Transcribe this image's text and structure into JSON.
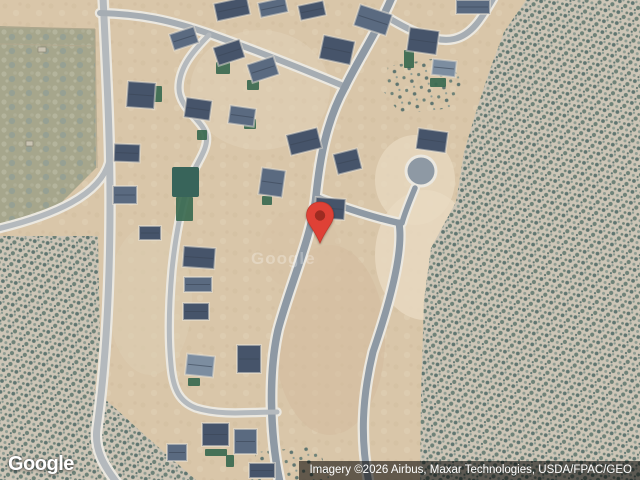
{
  "map": {
    "watermark_center": "Google",
    "logo_text": "Google",
    "attribution_text": "Imagery ©2026 Airbus, Maxar Technologies, USDA/FPAC/GEO",
    "colors": {
      "dirt": "#d9c6a9",
      "field": "#a6a68c",
      "scrub_base": "#cdc5b6",
      "scrub_dot1": "#5f7570",
      "scrub_dot2": "#6e8278",
      "scrub_dot3": "#8d9c92",
      "road_light": "#b4b9bd",
      "road_mid": "#a6adb3",
      "road_dark": "#8e99a4",
      "road_curb": "#ebe8e0",
      "house_dark": "#46546a",
      "house_mid": "#5a6a80",
      "house_light": "#7c8da0",
      "lawn": "#3a6950",
      "pond": "#38645a",
      "fence": "#b1a88e",
      "pin_red": "#df4136",
      "pin_dot": "#9e2b21"
    },
    "pin": {
      "tip_x": 320,
      "tip_y": 243
    },
    "field_polygon": "0,26 95,29 96,168 58,206 0,233",
    "field_marks": [
      [
        38,
        47,
        8,
        5
      ],
      [
        26,
        141,
        7,
        5
      ]
    ],
    "fences": [
      [
        0,
        44,
        94,
        46
      ],
      [
        95,
        29,
        97,
        168
      ],
      [
        0,
        27,
        95,
        29
      ]
    ],
    "dirt_shades": [
      [
        330,
        340,
        55,
        95,
        "#d3bc9e",
        0.55
      ],
      [
        425,
        255,
        50,
        65,
        "#e8dac2",
        0.8
      ],
      [
        415,
        180,
        40,
        45,
        "#e8dac2",
        0.7
      ],
      [
        150,
        300,
        42,
        75,
        "#dccdb2",
        0.6
      ],
      [
        260,
        90,
        70,
        60,
        "#e2d2ba",
        0.45
      ],
      [
        300,
        250,
        40,
        40,
        "#d8c2a6",
        0.5
      ]
    ],
    "scrub_areas": [
      {
        "pts": "0,236 98,236 100,340 95,390 148,438 196,480 0,480",
        "pat": "dense"
      },
      {
        "pts": "526,0 640,0 640,480 420,480 421,396 424,300 431,248 456,202 464,152 476,112 489,72 504,32",
        "pat": "dense"
      },
      {
        "pts": "388,66 438,58 463,78 452,108 400,114 384,92",
        "pat": "sparse"
      },
      {
        "pts": "256,452 318,446 330,480 250,480",
        "pat": "sparse"
      }
    ],
    "roads": [
      {
        "d": "M 109,162 C 100,195 55,215 -3,229",
        "w": 5.5,
        "c": "road_light"
      },
      {
        "d": "M 103,-3 C 106,60 110,130 110,200 C 110,300 105,370 97,428 C 94,450 104,466 117,483",
        "w": 7,
        "c": "road_light"
      },
      {
        "d": "M 100,13 C 140,14 170,20 210,34 C 260,52 310,72 346,87",
        "w": 6,
        "c": "road_mid"
      },
      {
        "d": "M 387,17 C 412,32 436,43 454,39 C 472,35 482,18 494,-3",
        "w": 6,
        "c": "road_mid"
      },
      {
        "d": "M 392,-3 C 378,30 358,60 345,87 C 326,122 320,158 316,196 C 312,236 290,285 278,330 C 269,370 269,430 280,483",
        "w": 7.5,
        "c": "road_dark"
      },
      {
        "d": "M 316,197 C 342,207 372,217 399,223",
        "w": 6.5,
        "c": "road_dark"
      },
      {
        "d": "M 399,223 C 404,252 388,308 373,352 C 362,398 360,440 369,483",
        "w": 7,
        "c": "road_dark"
      },
      {
        "d": "M 415,188 C 410,200 405,212 402,223",
        "w": 5.5,
        "c": "road_dark"
      },
      {
        "d": "M 209,35 C 192,52 179,68 179,88 C 179,108 202,120 206,134 C 210,150 193,166 188,185 C 180,212 175,240 172,270 C 169,305 168,335 171,365 C 173,390 180,402 196,408 C 222,416 250,412 277,412",
        "w": 5,
        "c": "road_light"
      }
    ],
    "culdesac": {
      "cx": 421,
      "cy": 171,
      "r": 13.5
    },
    "pond": [
      172,
      167,
      27,
      30
    ],
    "lawns": [
      [
        216,
        62,
        14,
        12
      ],
      [
        247,
        80,
        12,
        10
      ],
      [
        404,
        50,
        10,
        18
      ],
      [
        430,
        78,
        16,
        9
      ],
      [
        176,
        197,
        17,
        24
      ],
      [
        244,
        119,
        12,
        10
      ],
      [
        262,
        196,
        10,
        9
      ],
      [
        205,
        449,
        22,
        7
      ],
      [
        226,
        455,
        8,
        12
      ],
      [
        188,
        378,
        12,
        8
      ],
      [
        152,
        86,
        10,
        16
      ],
      [
        197,
        130,
        10,
        10
      ]
    ],
    "houses": [
      [
        215,
        0,
        34,
        18,
        -12,
        0
      ],
      [
        259,
        0,
        28,
        15,
        -12,
        1
      ],
      [
        299,
        3,
        26,
        15,
        -12,
        0
      ],
      [
        356,
        9,
        34,
        22,
        18,
        1
      ],
      [
        321,
        38,
        32,
        24,
        12,
        0
      ],
      [
        408,
        29,
        30,
        24,
        8,
        0
      ],
      [
        456,
        0,
        34,
        14,
        0,
        1
      ],
      [
        432,
        60,
        24,
        16,
        6,
        2
      ],
      [
        127,
        82,
        28,
        26,
        4,
        0
      ],
      [
        114,
        144,
        26,
        18,
        2,
        0
      ],
      [
        113,
        186,
        24,
        18,
        0,
        1
      ],
      [
        139,
        226,
        22,
        14,
        0,
        0
      ],
      [
        171,
        30,
        26,
        17,
        -18,
        1
      ],
      [
        215,
        43,
        28,
        19,
        -18,
        0
      ],
      [
        249,
        60,
        28,
        19,
        -18,
        1
      ],
      [
        185,
        99,
        26,
        20,
        8,
        0
      ],
      [
        229,
        107,
        26,
        18,
        8,
        1
      ],
      [
        288,
        131,
        32,
        21,
        -14,
        0
      ],
      [
        335,
        151,
        25,
        21,
        -14,
        0
      ],
      [
        260,
        169,
        24,
        27,
        8,
        1
      ],
      [
        315,
        198,
        30,
        21,
        4,
        0
      ],
      [
        417,
        130,
        30,
        21,
        8,
        0
      ],
      [
        183,
        247,
        32,
        21,
        4,
        0
      ],
      [
        184,
        277,
        28,
        15,
        0,
        1
      ],
      [
        183,
        303,
        26,
        17,
        0,
        0
      ],
      [
        186,
        355,
        28,
        21,
        6,
        2
      ],
      [
        237,
        345,
        24,
        28,
        0,
        0
      ],
      [
        202,
        423,
        27,
        23,
        0,
        0
      ],
      [
        234,
        429,
        23,
        25,
        0,
        1
      ],
      [
        249,
        463,
        26,
        15,
        0,
        0
      ],
      [
        167,
        444,
        20,
        17,
        0,
        1
      ]
    ]
  }
}
